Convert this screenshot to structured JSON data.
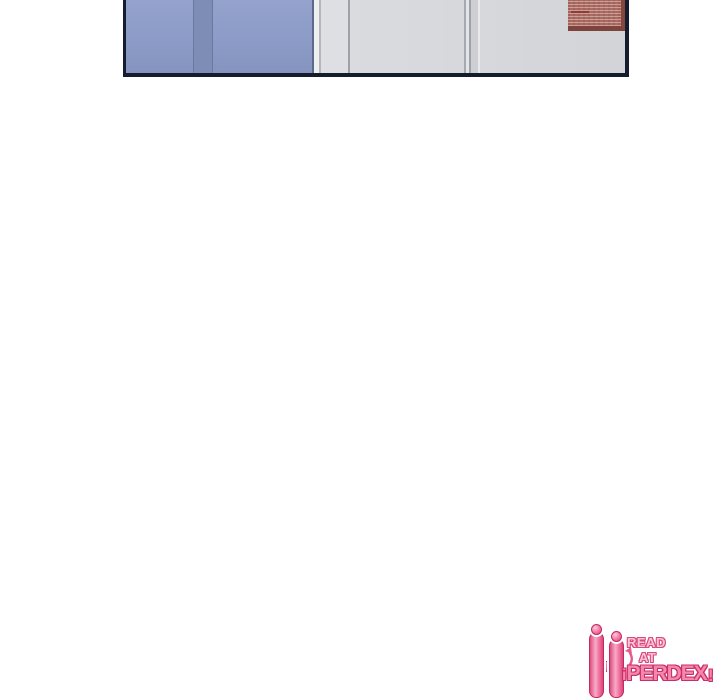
{
  "page": {
    "background_color": "#ffffff"
  },
  "comic_panel": {
    "border_color": "#151c2e",
    "blue_door": {
      "base_color": "#8d9cc8",
      "stripe_color": "#7e8db6",
      "edge_line_color": "#6b79a0"
    },
    "gray_wall": {
      "base_color": "#d6d8dc",
      "light_strip_color": "#edeff1",
      "frame_line_color": "#9da1a8"
    },
    "poster": {
      "base_color": "#a96c64",
      "border_color": "#7c443d",
      "text_texture_color": "#ecc8c1",
      "heading_line_color": "#8f3b38"
    }
  },
  "watermark": {
    "brand": "HiPERDEX.COM",
    "read": "READ",
    "at": "AT",
    "brand_i": "i",
    "brand_name": "PERDEX",
    "brand_bang": "!",
    "brand_tld": ".COM",
    "pink": "#f387ac",
    "dark_pink": "#c92e66",
    "light_pink": "#fbc3d6"
  }
}
